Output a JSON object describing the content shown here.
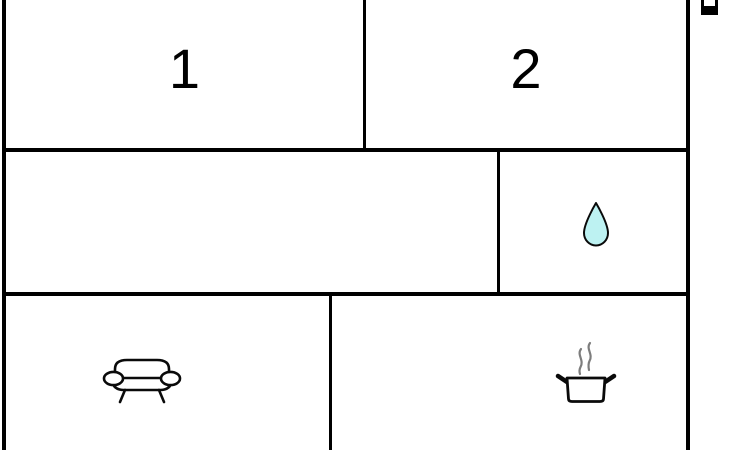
{
  "floorplan": {
    "title": "apartment-floor-plan",
    "rooms": [
      {
        "name": "bedroom-1",
        "label": "1"
      },
      {
        "name": "bedroom-2",
        "label": "2"
      },
      {
        "name": "hallway",
        "label": ""
      },
      {
        "name": "bathroom",
        "label": "",
        "icon": "water-drop-icon"
      },
      {
        "name": "living-room",
        "label": "",
        "icon": "sofa-icon"
      },
      {
        "name": "kitchen",
        "label": "",
        "icon": "cooking-pot-icon"
      }
    ],
    "colors": {
      "wall": "#000000",
      "background": "#ffffff",
      "water_drop_fill": "#bdf2f2",
      "icon_outline": "#0a0a0a",
      "steam": "#7d7d7d"
    }
  }
}
